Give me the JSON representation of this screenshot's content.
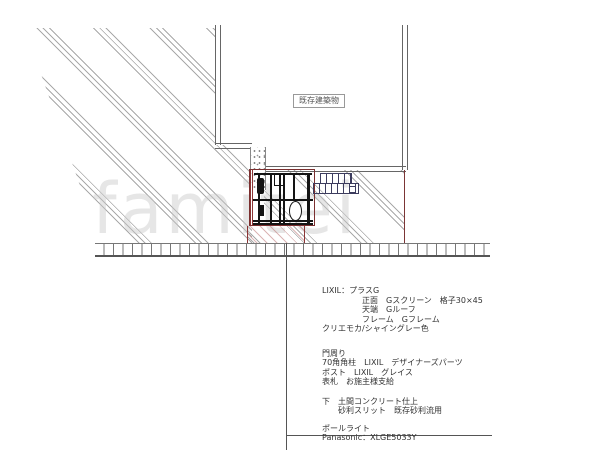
{
  "drawing": {
    "building_label": "既存建築物",
    "watermark": "famitei"
  },
  "notes": {
    "lines": [
      "LIXIL：プラスG",
      "正面　Gスクリーン　格子30×45",
      "天端　Gルーフ",
      "フレーム　Gフレーム",
      "クリエモカ/シャイングレー色",
      "門周り",
      "70角角柱　LIXIL　デザイナーズパーツ",
      "ポスト　LIXIL　グレイス",
      "表札　お施主様支給",
      "下　土間コンクリート仕上",
      "砂利スリット　既存砂利流用",
      "ポールライト",
      "Panasonic：XLGE5033Y"
    ]
  },
  "colors": {
    "outline_gray": "#666666",
    "hatch_gray": "#a9a9a9",
    "detail_black": "#141414",
    "boundary_maroon": "#8b3535",
    "screen_navy": "#3c3c5e",
    "watermark_gray": "#c9c9c9",
    "text_gray": "#333333"
  }
}
